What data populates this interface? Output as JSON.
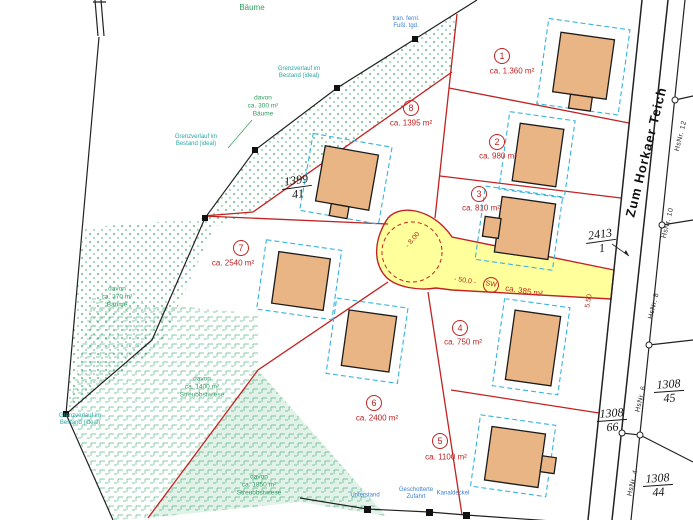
{
  "street": {
    "name": "Zum Horkaer Teich"
  },
  "parcels": [
    {
      "no": "1",
      "area": "ca. 1.360 m²"
    },
    {
      "no": "2",
      "area": "ca. 980 m²"
    },
    {
      "no": "3",
      "area": "ca. 810 m²"
    },
    {
      "no": "4",
      "area": "ca. 750 m²"
    },
    {
      "no": "5",
      "area": "ca. 1100 m²"
    },
    {
      "no": "6",
      "area": "ca. 2400 m²"
    },
    {
      "no": "7",
      "area": "ca. 2540 m²"
    },
    {
      "no": "8",
      "area": "ca. 1395 m²"
    }
  ],
  "road": {
    "badge": "SW",
    "area": "ca. 385 m²",
    "length_label": "- 50.0 -",
    "radius_label": "- 8.00",
    "width_label": "5.50"
  },
  "flurstuecke": [
    {
      "num": "1399",
      "den": "41"
    },
    {
      "num": "2413",
      "den": "1"
    },
    {
      "num": "1308",
      "den": "66"
    },
    {
      "num": "1308",
      "den": "45"
    },
    {
      "num": "1308",
      "den": "44"
    }
  ],
  "house_numbers": [
    "HsNr. 12",
    "HsNr. 10",
    "HsNr. 8",
    "HsNr. 6",
    "HsNr. 4"
  ],
  "labels": {
    "baeume_top": "Bäume",
    "veg300": {
      "l1": "davon",
      "l2": "ca. 300 m²",
      "l3": "Bäume"
    },
    "veg370": {
      "l1": "davon",
      "l2": "ca. 370 m²",
      "l3": "Bäume"
    },
    "veg1400": {
      "l1": "davon",
      "l2": "ca. 1400 m²",
      "l3": "Streuobstwiese"
    },
    "veg1850": {
      "l1": "davon",
      "l2": "ca. 1850 m²",
      "l3": "Streuobstwiese"
    },
    "grenz": {
      "l1": "Grenzverlauf im",
      "l2": "Bestand (ideal)"
    },
    "survey_top": {
      "l1": "tran. fernl.",
      "l2": "Fußl. tgd."
    },
    "unterstand": "Unterstand",
    "zufahrt": {
      "l1": "Geschotterte",
      "l2": "Zufahrt"
    },
    "kanal": "Kanaldeckel"
  },
  "colors": {
    "parcel_line": "#c22222",
    "road_fill": "#ffff9c",
    "house_fill": "#eab584",
    "setback_dash": "#35b4e0",
    "trees_green": "#3aa565",
    "note_teal": "#2aa7a0",
    "note_blue": "#3a7fd5"
  }
}
